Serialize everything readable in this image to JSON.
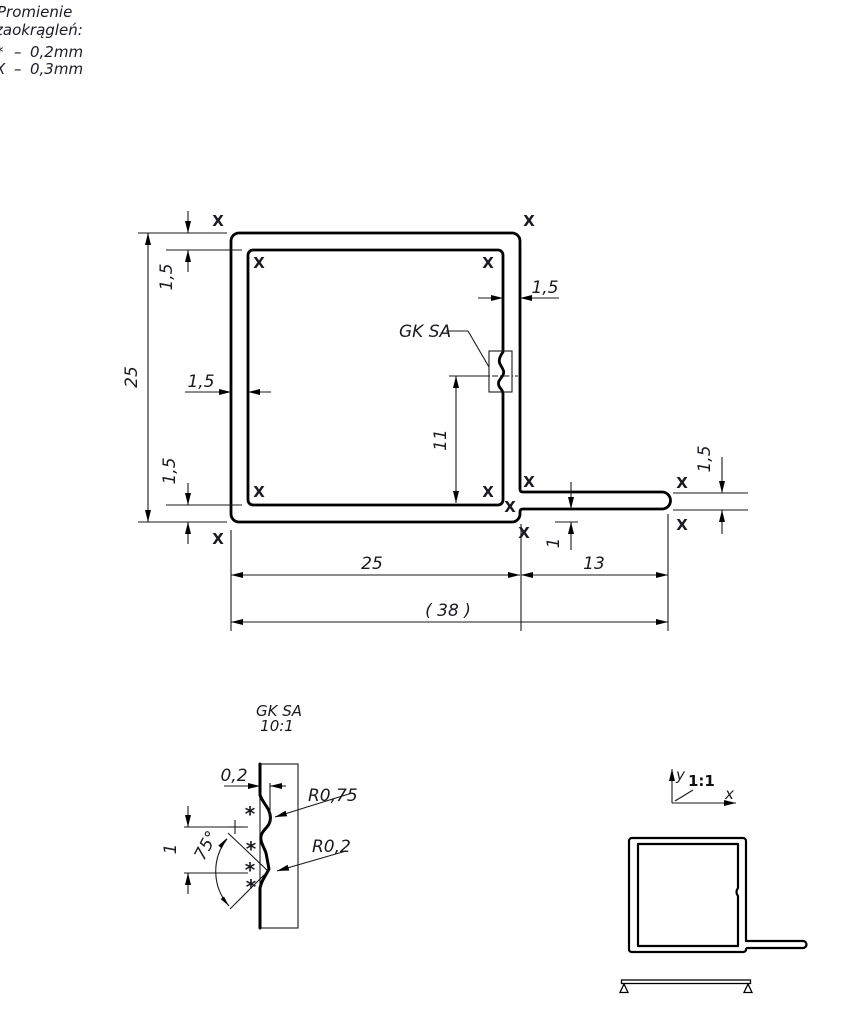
{
  "legend": {
    "title_line1": "Promienie",
    "title_line2": "zaokrągleń:",
    "item1_symbol": "*",
    "item1_dash": "–",
    "item1_value": "0,2mm",
    "item2_symbol": "X",
    "item2_dash": "–",
    "item2_value": "0,3mm"
  },
  "marks": {
    "fillet_03": "X",
    "fillet_02": "*"
  },
  "main_view": {
    "detail_label": "GK SA",
    "dim_height": "25",
    "dim_width": "25",
    "dim_flange_length": "13",
    "dim_overall": "( 38 )",
    "dim_wall_top": "1,5",
    "dim_wall_bottom": "1,5",
    "dim_wall_left": "1,5",
    "dim_wall_right": "1,5",
    "dim_flange_thickness": "1,5",
    "dim_groove_height": "11",
    "dim_flange_offset": "1"
  },
  "detail_view": {
    "title": "GK SA",
    "scale": "10:1",
    "dim_depth": "0,2",
    "dim_radius_outer": "R0,75",
    "dim_radius_inner": "R0,2",
    "dim_angle": "75°",
    "dim_pitch": "1"
  },
  "scale_view": {
    "scale_label": "1:1",
    "axis_x_label": "x",
    "axis_y_label": "y"
  }
}
